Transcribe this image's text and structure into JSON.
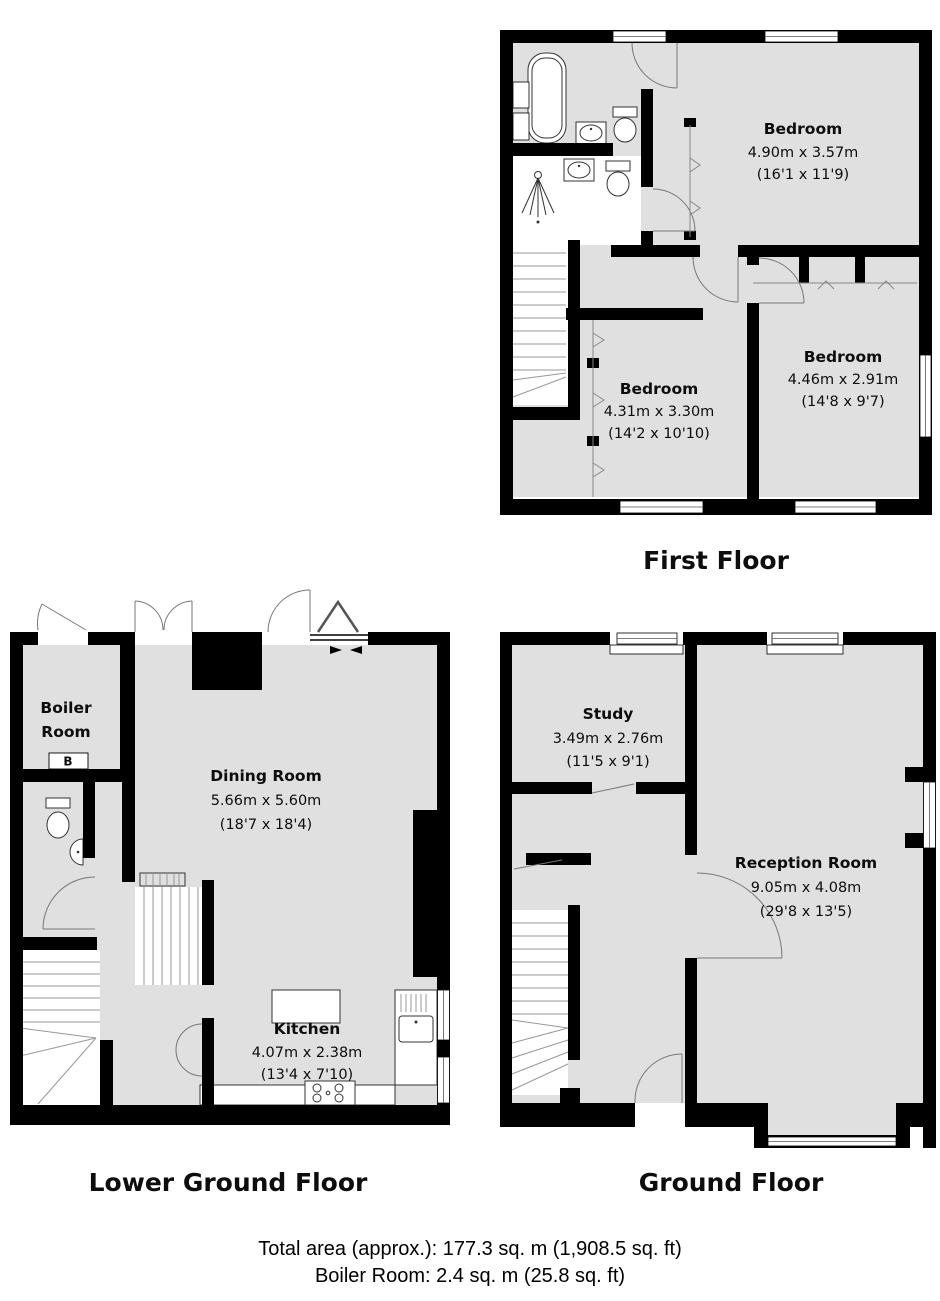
{
  "page": {
    "background": "#ffffff"
  },
  "colors": {
    "wall": "#000000",
    "floor_fill": "#e0e0e0",
    "door_swing": "#777777",
    "text": "#0d0d0d"
  },
  "floors": [
    {
      "id": "first-floor",
      "title": "First Floor",
      "rooms": [
        {
          "id": "bedroom-1",
          "lines": [
            "Bedroom",
            "4.90m x 3.57m",
            "(16'1 x 11'9)"
          ]
        },
        {
          "id": "bedroom-2",
          "lines": [
            "Bedroom",
            "4.31m x 3.30m",
            "(14'2 x 10'10)"
          ]
        },
        {
          "id": "bedroom-3",
          "lines": [
            "Bedroom",
            "4.46m x 2.91m",
            "(14'8 x 9'7)"
          ]
        }
      ]
    },
    {
      "id": "lower-ground-floor",
      "title": "Lower Ground Floor",
      "rooms": [
        {
          "id": "boiler-room",
          "lines": [
            "Boiler",
            "Room"
          ],
          "marker": "B"
        },
        {
          "id": "dining-room",
          "lines": [
            "Dining Room",
            "5.66m x 5.60m",
            "(18'7 x 18'4)"
          ]
        },
        {
          "id": "kitchen",
          "lines": [
            "Kitchen",
            "4.07m x 2.38m",
            "(13'4 x 7'10)"
          ]
        }
      ]
    },
    {
      "id": "ground-floor",
      "title": "Ground Floor",
      "rooms": [
        {
          "id": "study",
          "lines": [
            "Study",
            "3.49m x 2.76m",
            "(11'5 x 9'1)"
          ]
        },
        {
          "id": "reception-room",
          "lines": [
            "Reception Room",
            "9.05m x 4.08m",
            "(29'8 x 13'5)"
          ]
        }
      ]
    }
  ],
  "footer": {
    "line1": "Total area (approx.): 177.3 sq. m (1,908.5 sq. ft)",
    "line2": "Boiler Room: 2.4 sq. m (25.8 sq. ft)"
  }
}
